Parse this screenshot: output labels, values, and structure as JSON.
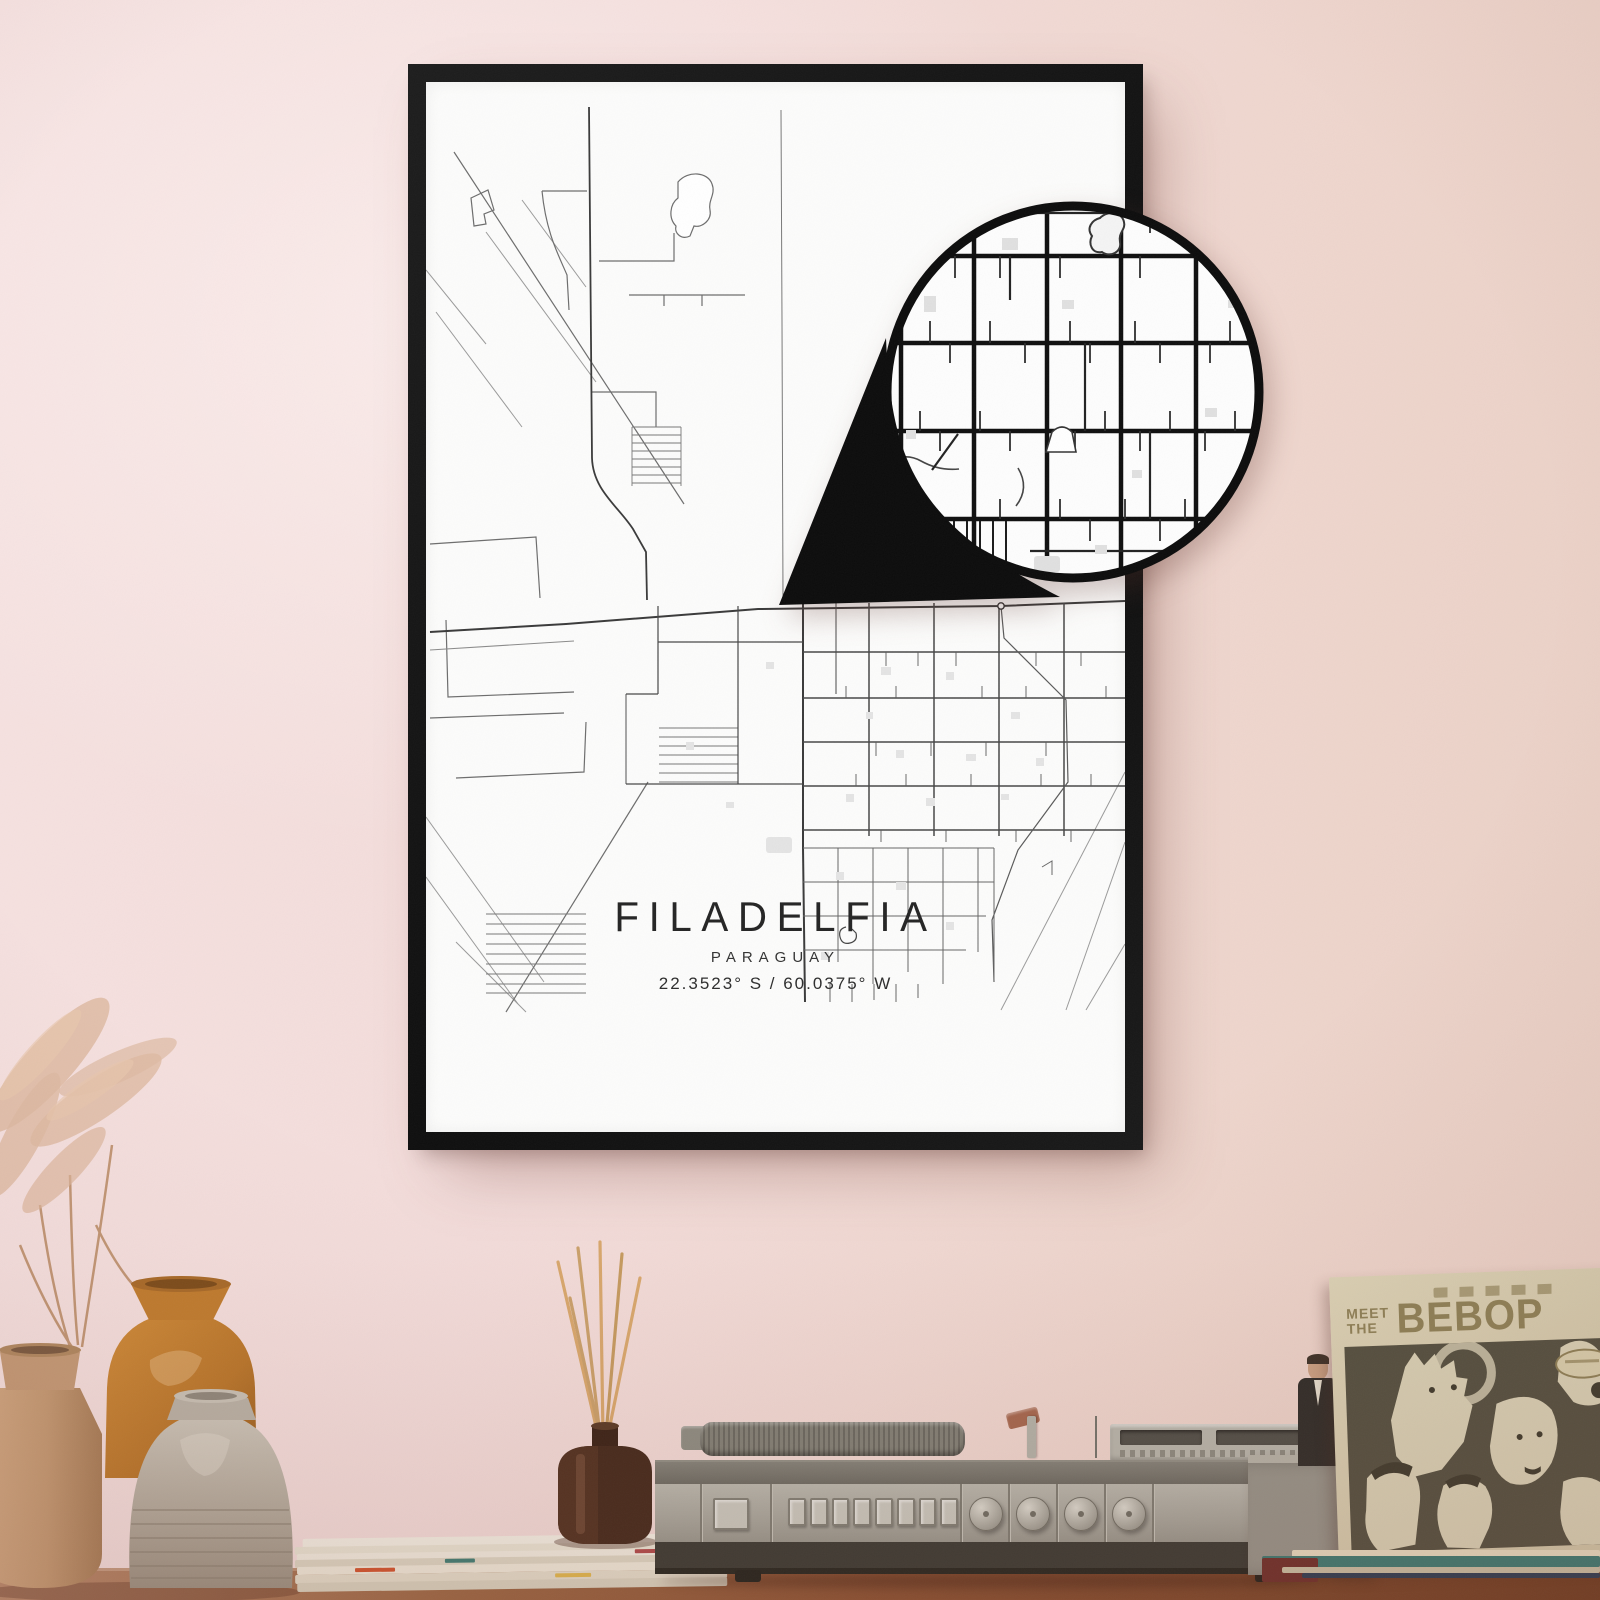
{
  "poster": {
    "title": "FILADELFIA",
    "subtitle": "PARAGUAY",
    "coordinates": "22.3523° S / 60.0375° W",
    "frame_color": "#141414",
    "paper_color": "#fcfcfb",
    "map_line_color": "#3a3a3a"
  },
  "zoom_bubble": {
    "ring_color": "#0c0c0c",
    "fill_color": "#fdfdfd"
  },
  "album": {
    "title_line1": "MEET",
    "title_line2": "THE",
    "title_line3": "BEBOP",
    "cover_color": "#d5cbae",
    "text_color": "#8e8157",
    "photo_background": "#535040"
  },
  "wall": {
    "color_left": "#f5e1e0",
    "color_right": "#ebd3c9"
  },
  "table": {
    "wood_color": "#8a5132"
  }
}
